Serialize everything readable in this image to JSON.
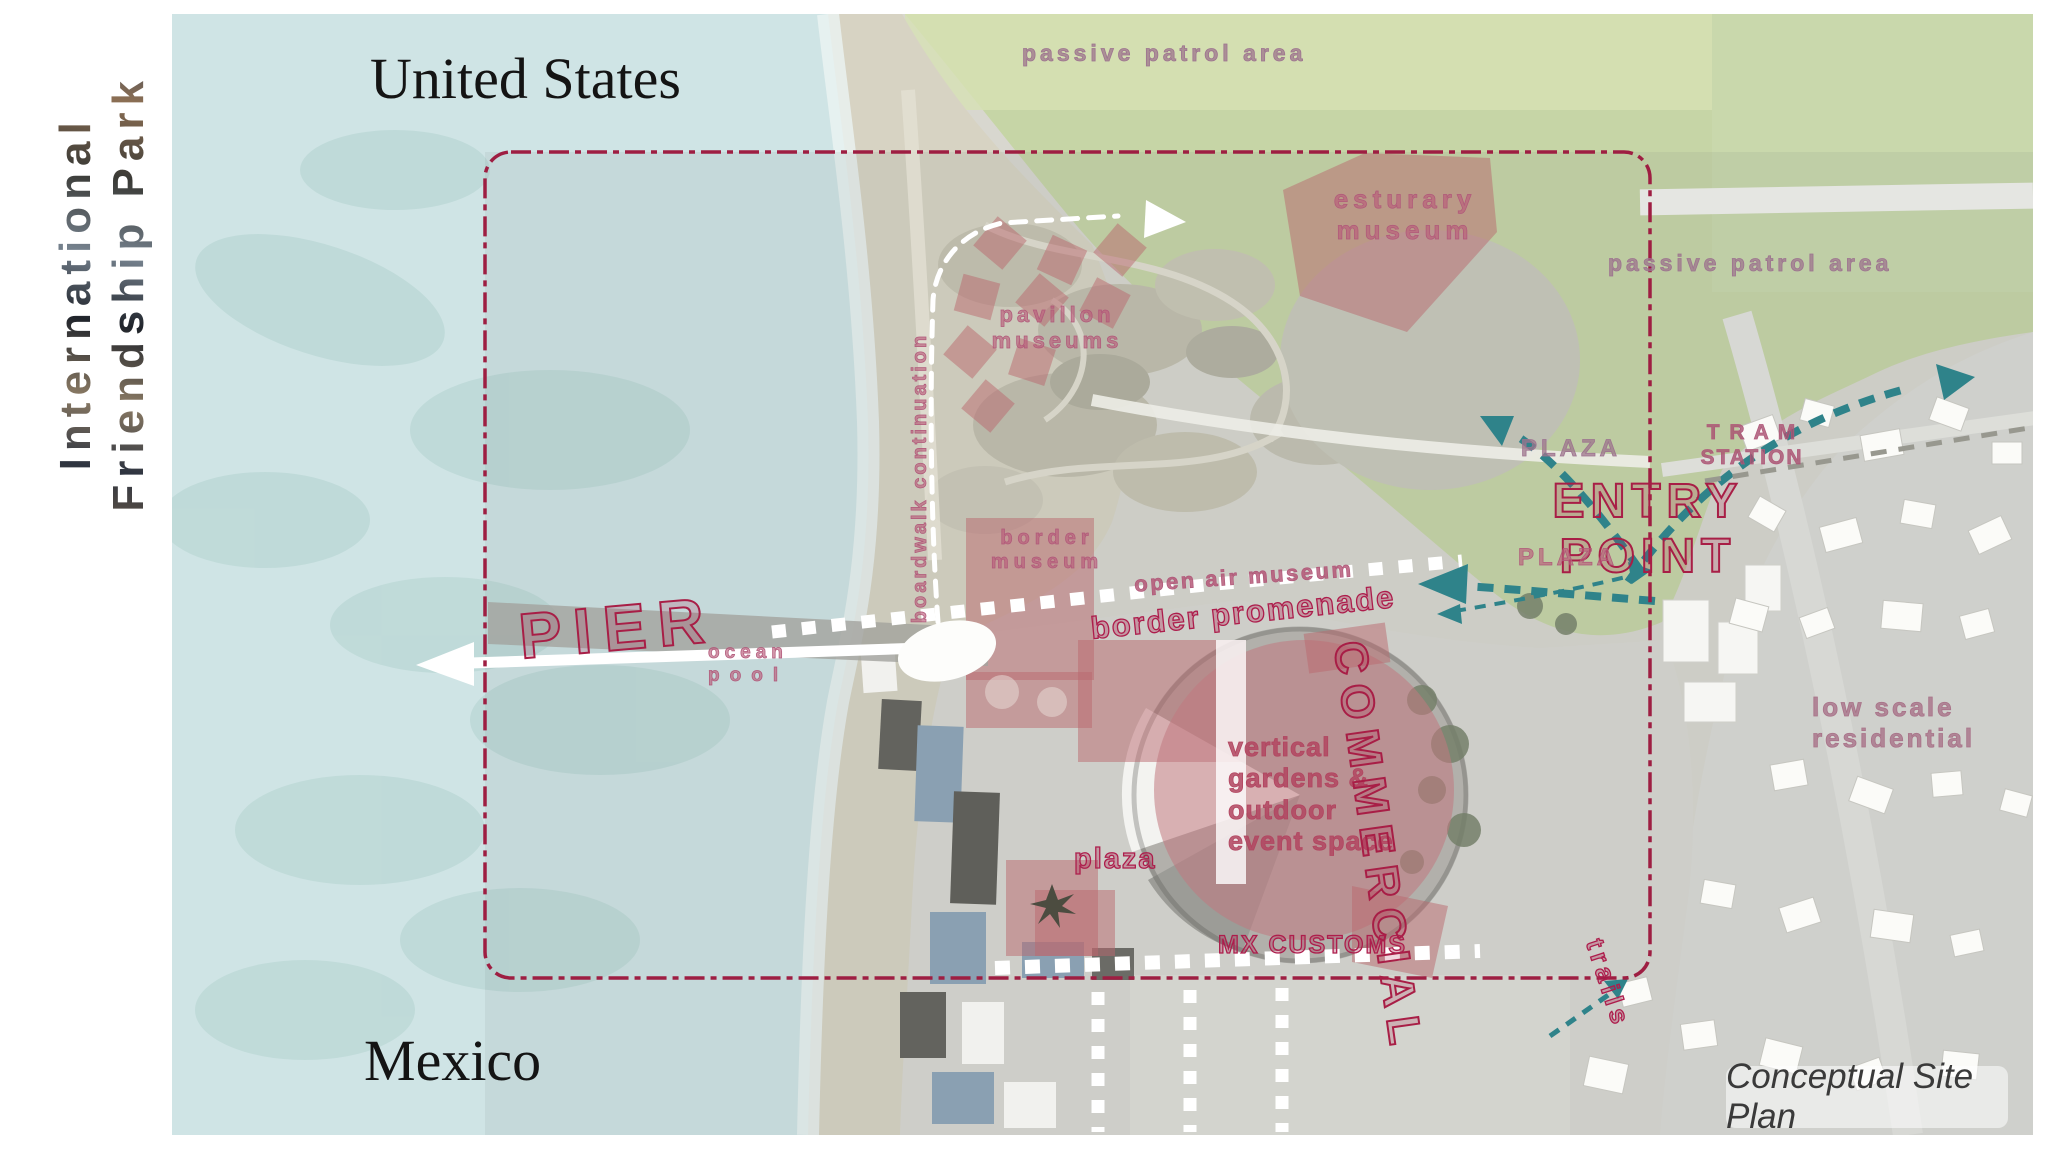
{
  "sidebar": {
    "title_line1": "International",
    "title_line2": "Friendship Park"
  },
  "map": {
    "countries": {
      "us": "United States",
      "mx": "Mexico"
    },
    "labels": {
      "passive_patrol": "passive patrol area",
      "estuary_l1": "esturary",
      "estuary_l2": "museum",
      "pavilion_l1": "pavillon",
      "pavilion_l2": "museums",
      "boardwalk": "boardwalk continuation",
      "pier": "PIER",
      "ocean_l1": "ocean",
      "ocean_l2": "pool",
      "entry_l1": "ENTRY",
      "entry_l2": "POINT",
      "plaza_upper": "PLAZA",
      "plaza_lower": "PLAZA",
      "tram_l1": "T R A M",
      "tram_l2": "STATION",
      "border_museum_l1": "border",
      "border_museum_l2": "museum",
      "open_air": "open air museum",
      "promenade": "border promenade",
      "plaza_small": "plaza",
      "gardens_l1": "vertical",
      "gardens_l2": "gardens &",
      "gardens_l3": "outdoor",
      "gardens_l4": "event space",
      "commercial": "COMMERCIAL",
      "mx_customs": "MX CUSTOMS",
      "low_scale_l1": "low scale",
      "low_scale_l2": "residential",
      "trails": "trails"
    },
    "caption": "Conceptual Site Plan"
  },
  "colors": {
    "boundary_red": "#9e1e42",
    "overlay_pink": "#bd6c71",
    "route_teal": "#2f838a",
    "ocean_blue": "#cfe4e5",
    "upland_green": "#c6d5a6",
    "label_pink": "#ad1d4c",
    "label_mauve": "#9d7390"
  }
}
